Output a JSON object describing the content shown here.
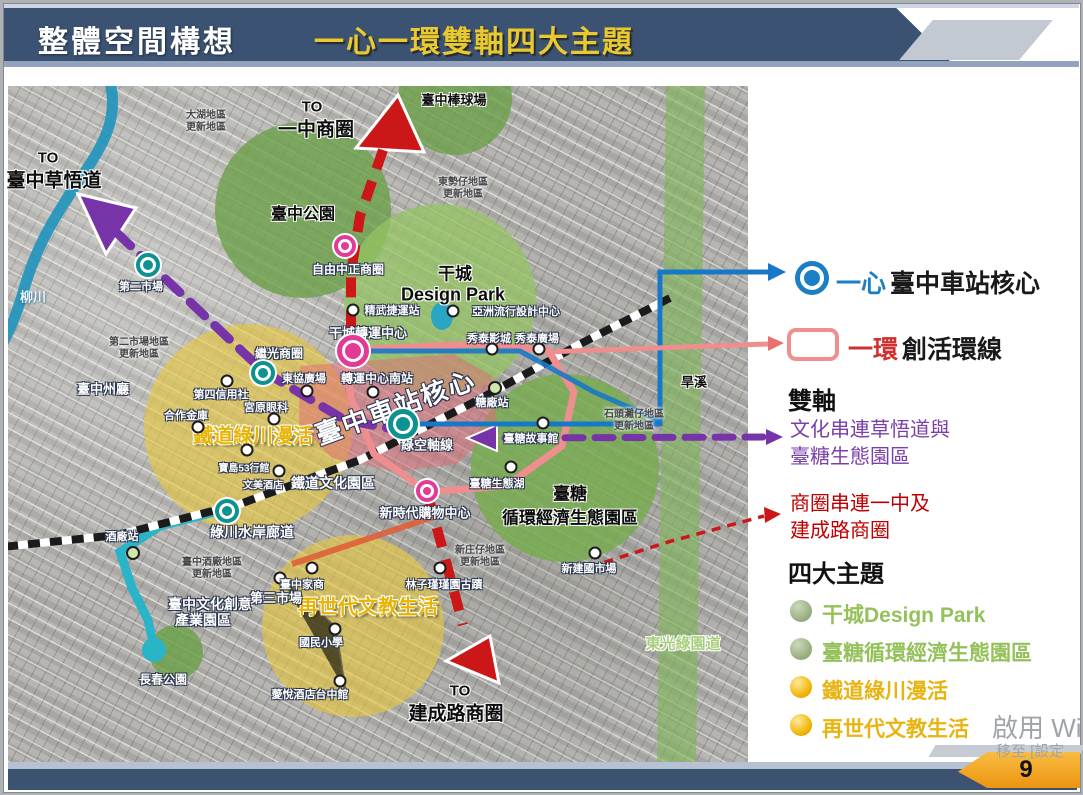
{
  "header": {
    "title": "整體空間構想",
    "subtitle": "一心一環雙軸四大主題"
  },
  "footer": {
    "page_number": "9"
  },
  "watermark": {
    "line1": "啟用 Wi",
    "line2": "移至 [設定"
  },
  "legend": {
    "core": {
      "term": "一心",
      "desc": "臺中車站核心",
      "color": "#1a7fc4"
    },
    "ring": {
      "term": "一環",
      "desc": "創活環線",
      "color": "#ef9090"
    },
    "axes": {
      "title": "雙軸",
      "axis1_line1": "文化串連草悟道與",
      "axis1_line2": "臺糖生態園區",
      "axis1_color": "#7a3fa8",
      "axis2_line1": "商圈串連一中及",
      "axis2_line2": "建成路商圈",
      "axis2_color": "#c00000"
    },
    "themes": {
      "title": "四大主題",
      "items": [
        {
          "label": "干城Design Park",
          "color": "#94c15a"
        },
        {
          "label": "臺糖循環經濟生態園區",
          "color": "#94c15a"
        },
        {
          "label": "鐵道綠川漫活",
          "color": "#e7b412"
        },
        {
          "label": "再世代文教生活",
          "color": "#e7b412"
        }
      ]
    }
  },
  "map": {
    "to": {
      "t1": "TO",
      "caowu": "臺中草悟道",
      "t2": "TO",
      "yizhong": "一中商圈",
      "t3": "TO",
      "jiancheng": "建成路商圈"
    },
    "areas": {
      "park": "臺中公園",
      "baseball": "臺中棒球場",
      "gancheng1": "干城",
      "gancheng2": "Design Park",
      "taisugar1": "臺糖",
      "taisugar2": "循環經濟生態園區",
      "rail_green": "鐵道綠川漫活",
      "nextgen": "再世代文教生活",
      "changchun": "長春公園",
      "cultural1": "臺中文化創意",
      "cultural2": "產業園區"
    },
    "water": {
      "liuchuan": "柳川",
      "hanxi": "旱溪",
      "dongguang": "東光綠園道",
      "greenway": "綠川水岸廊道"
    },
    "core": {
      "station_core": "臺中車站核心",
      "green_axis": "綠空軸線",
      "transfer": "干城轉運中心",
      "transfer_south": "轉運中心南站",
      "ziyou": "自由中正商圈",
      "jiguang": "繼光商圈",
      "prefectural": "臺中州廳"
    },
    "renewal": {
      "dahu1": "大湖地區",
      "dahu2": "更新地區",
      "dongshi1": "東勢仔地區",
      "dongshi2": "更新地區",
      "market1": "第二市場地區",
      "market2": "更新地區",
      "stone1": "石頭灘仔地區",
      "stone2": "更新地區",
      "winery1": "臺中酒廠地區",
      "winery2": "更新地區",
      "xinzhuang1": "新庄仔地區",
      "xinzhuang2": "更新地區"
    },
    "pois": {
      "market2nd": "第二市場",
      "jingwu": "精武捷運站",
      "asia_design": "亞洲流行設計中心",
      "showtime_cinema": "秀泰影城",
      "showtime_plaza": "秀泰廣場",
      "sugar_station": "糖廠站",
      "sugar_story": "臺糖故事館",
      "sugar_lake": "臺糖生態湖",
      "asean": "東協廣場",
      "credit4": "第四信用社",
      "coop_bank": "合作金庫",
      "miyahara": "宮原眼科",
      "baodao53": "寶島53行館",
      "wenmei": "文美酒店",
      "rail_park": "鐵道文化園區",
      "shopping": "新時代購物中心",
      "winery_station": "酒廠站",
      "market3rd": "第三市場",
      "homeec": "臺中家商",
      "elementary": "國民小學",
      "inhouse": "薆悅酒店台中館",
      "linzijin": "林子瑾瑾園古蹟",
      "jianguo": "新建國市場"
    }
  }
}
